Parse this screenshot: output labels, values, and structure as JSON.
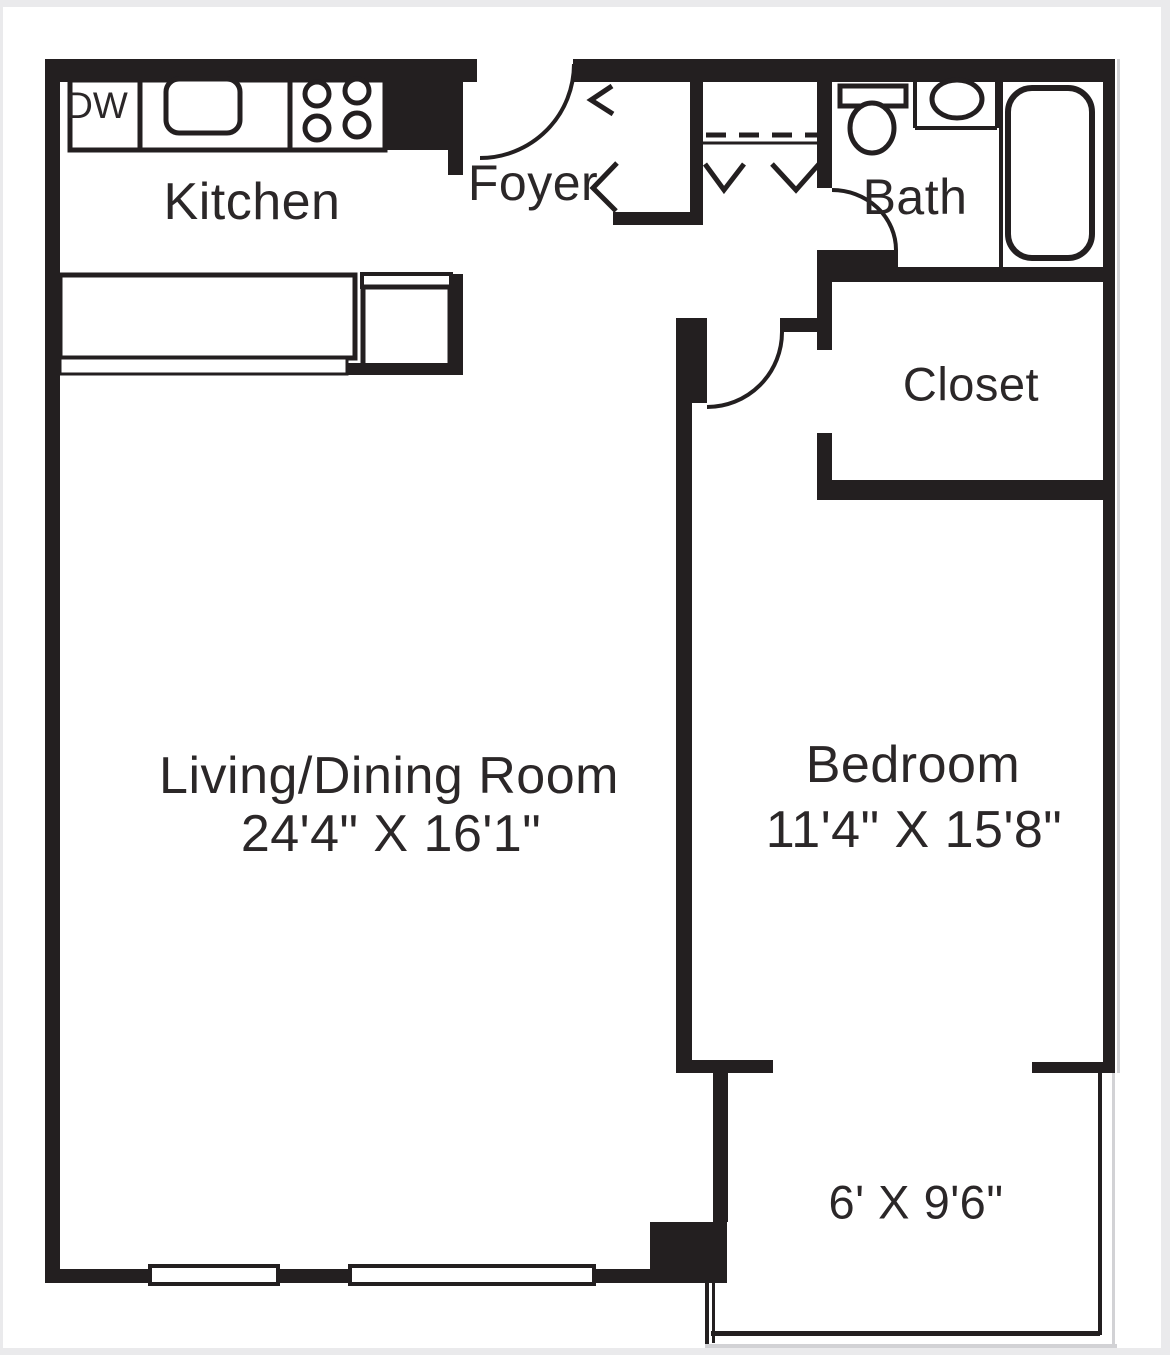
{
  "floor_plan": {
    "rooms": {
      "kitchen": {
        "label": "Kitchen"
      },
      "foyer": {
        "label": "Foyer"
      },
      "bath": {
        "label": "Bath"
      },
      "closet": {
        "label": "Closet"
      },
      "living_dining": {
        "label": "Living/Dining Room",
        "dimensions": "24'4\" X 16'1\""
      },
      "bedroom": {
        "label": "Bedroom",
        "dimensions": "11'4\" X 15'8\""
      },
      "balcony": {
        "dimensions": "6' X 9'6\""
      }
    },
    "appliances": {
      "dishwasher_label": "DW"
    },
    "colors": {
      "wall": "#231f20",
      "text": "#2b2728",
      "background": "#ffffff",
      "page_edge": "#eaeaec",
      "shadow_line": "#d2d2d5"
    }
  }
}
